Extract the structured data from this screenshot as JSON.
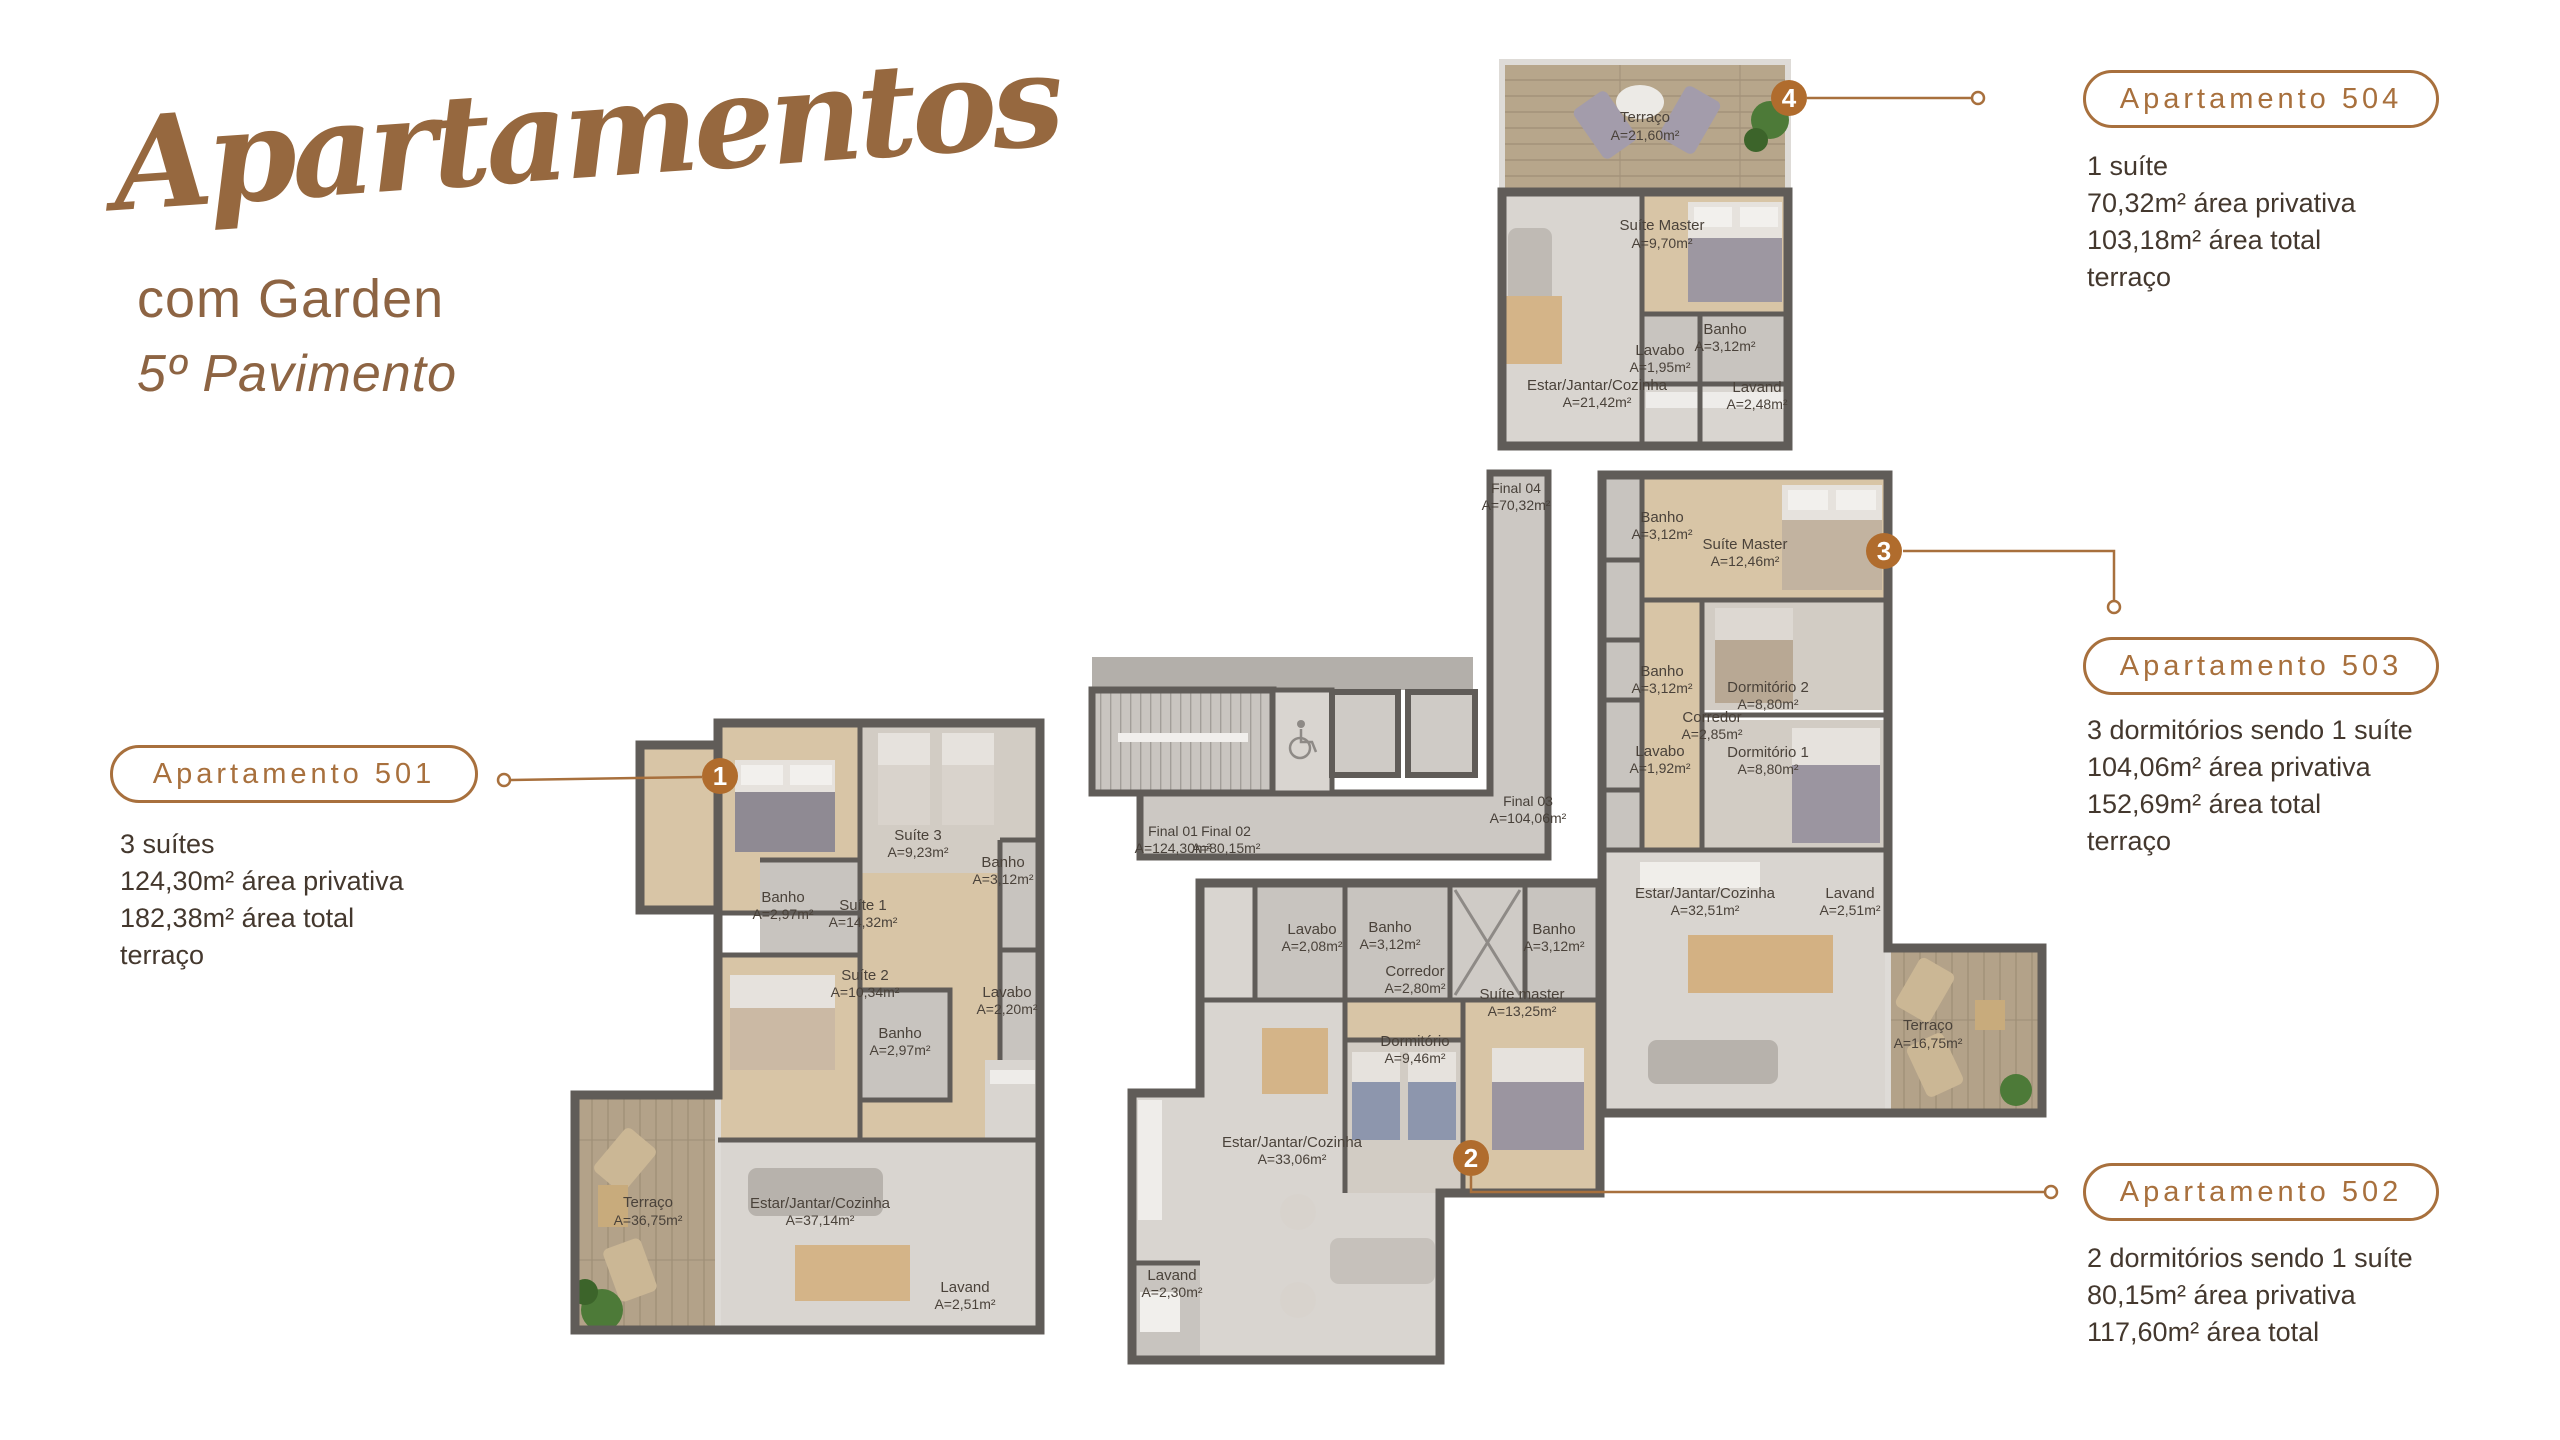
{
  "header": {
    "title_script": "Apartamentos",
    "subtitle": "com Garden",
    "floor": "5º Pavimento"
  },
  "colors": {
    "accent": "#b06c2d",
    "outline_brown": "#a8703d",
    "title_brown": "#96683f",
    "detail_text": "#44382e",
    "wall_gray": "#605c58"
  },
  "apartments": [
    {
      "number": "501",
      "pill": "Apartamento 501",
      "marker": "1",
      "details": [
        "3 suítes",
        "124,30m² área privativa",
        "182,38m² área total",
        "terraço"
      ],
      "rooms": [
        {
          "name": "Suíte 3",
          "area": "A=9,23m²"
        },
        {
          "name": "Banho",
          "area": "A=3,12m²"
        },
        {
          "name": "Banho",
          "area": "A=2,97m²"
        },
        {
          "name": "Suíte 1",
          "area": "A=14,32m²"
        },
        {
          "name": "Suíte 2",
          "area": "A=10,34m²"
        },
        {
          "name": "Lavabo",
          "area": "A=2,20m²"
        },
        {
          "name": "Banho",
          "area": "A=2,97m²"
        },
        {
          "name": "Terraço",
          "area": "A=36,75m²"
        },
        {
          "name": "Estar/Jantar/Cozinha",
          "area": "A=37,14m²"
        },
        {
          "name": "Lavand",
          "area": "A=2,51m²"
        }
      ]
    },
    {
      "number": "502",
      "pill": "Apartamento 502",
      "marker": "2",
      "details": [
        "2 dormitórios sendo 1 suíte",
        "80,15m² área privativa",
        "117,60m² área total"
      ],
      "rooms": [
        {
          "name": "Lavabo",
          "area": "A=2,08m²"
        },
        {
          "name": "Banho",
          "area": "A=3,12m²"
        },
        {
          "name": "Banho",
          "area": "A=3,12m²"
        },
        {
          "name": "Corredor",
          "area": "A=2,80m²"
        },
        {
          "name": "Suíte master",
          "area": "A=13,25m²"
        },
        {
          "name": "Dormitório",
          "area": "A=9,46m²"
        },
        {
          "name": "Estar/Jantar/Cozinha",
          "area": "A=33,06m²"
        },
        {
          "name": "Lavand",
          "area": "A=2,30m²"
        }
      ]
    },
    {
      "number": "503",
      "pill": "Apartamento 503",
      "marker": "3",
      "details": [
        "3 dormitórios sendo 1 suíte",
        "104,06m² área privativa",
        "152,69m² área total",
        "terraço"
      ],
      "rooms": [
        {
          "name": "Banho",
          "area": "A=3,12m²"
        },
        {
          "name": "Suíte Master",
          "area": "A=12,46m²"
        },
        {
          "name": "Dormitório 2",
          "area": "A=8,80m²"
        },
        {
          "name": "Banho",
          "area": "A=3,12m²"
        },
        {
          "name": "Corredor",
          "area": "A=2,85m²"
        },
        {
          "name": "Lavabo",
          "area": "A=1,92m²"
        },
        {
          "name": "Dormitório 1",
          "area": "A=8,80m²"
        },
        {
          "name": "Estar/Jantar/Cozinha",
          "area": "A=32,51m²"
        },
        {
          "name": "Lavand",
          "area": "A=2,51m²"
        },
        {
          "name": "Terraço",
          "area": "A=16,75m²"
        }
      ]
    },
    {
      "number": "504",
      "pill": "Apartamento 504",
      "marker": "4",
      "details": [
        "1 suíte",
        "70,32m² área privativa",
        "103,18m² área total",
        "terraço"
      ],
      "rooms": [
        {
          "name": "Terraço",
          "area": "A=21,60m²"
        },
        {
          "name": "Suíte Master",
          "area": "A=9,70m²"
        },
        {
          "name": "Banho",
          "area": "A=3,12m²"
        },
        {
          "name": "Lavabo",
          "area": "A=1,95m²"
        },
        {
          "name": "Estar/Jantar/Cozinha",
          "area": "A=21,42m²"
        },
        {
          "name": "Lavand",
          "area": "A=2,48m²"
        }
      ]
    }
  ],
  "core": {
    "units": [
      {
        "name": "Final 01",
        "area": "A=124,30m²"
      },
      {
        "name": "Final 02",
        "area": "A=80,15m²"
      },
      {
        "name": "Final 03",
        "area": "A=104,06m²"
      },
      {
        "name": "Final 04",
        "area": "A=70,32m²"
      }
    ]
  }
}
